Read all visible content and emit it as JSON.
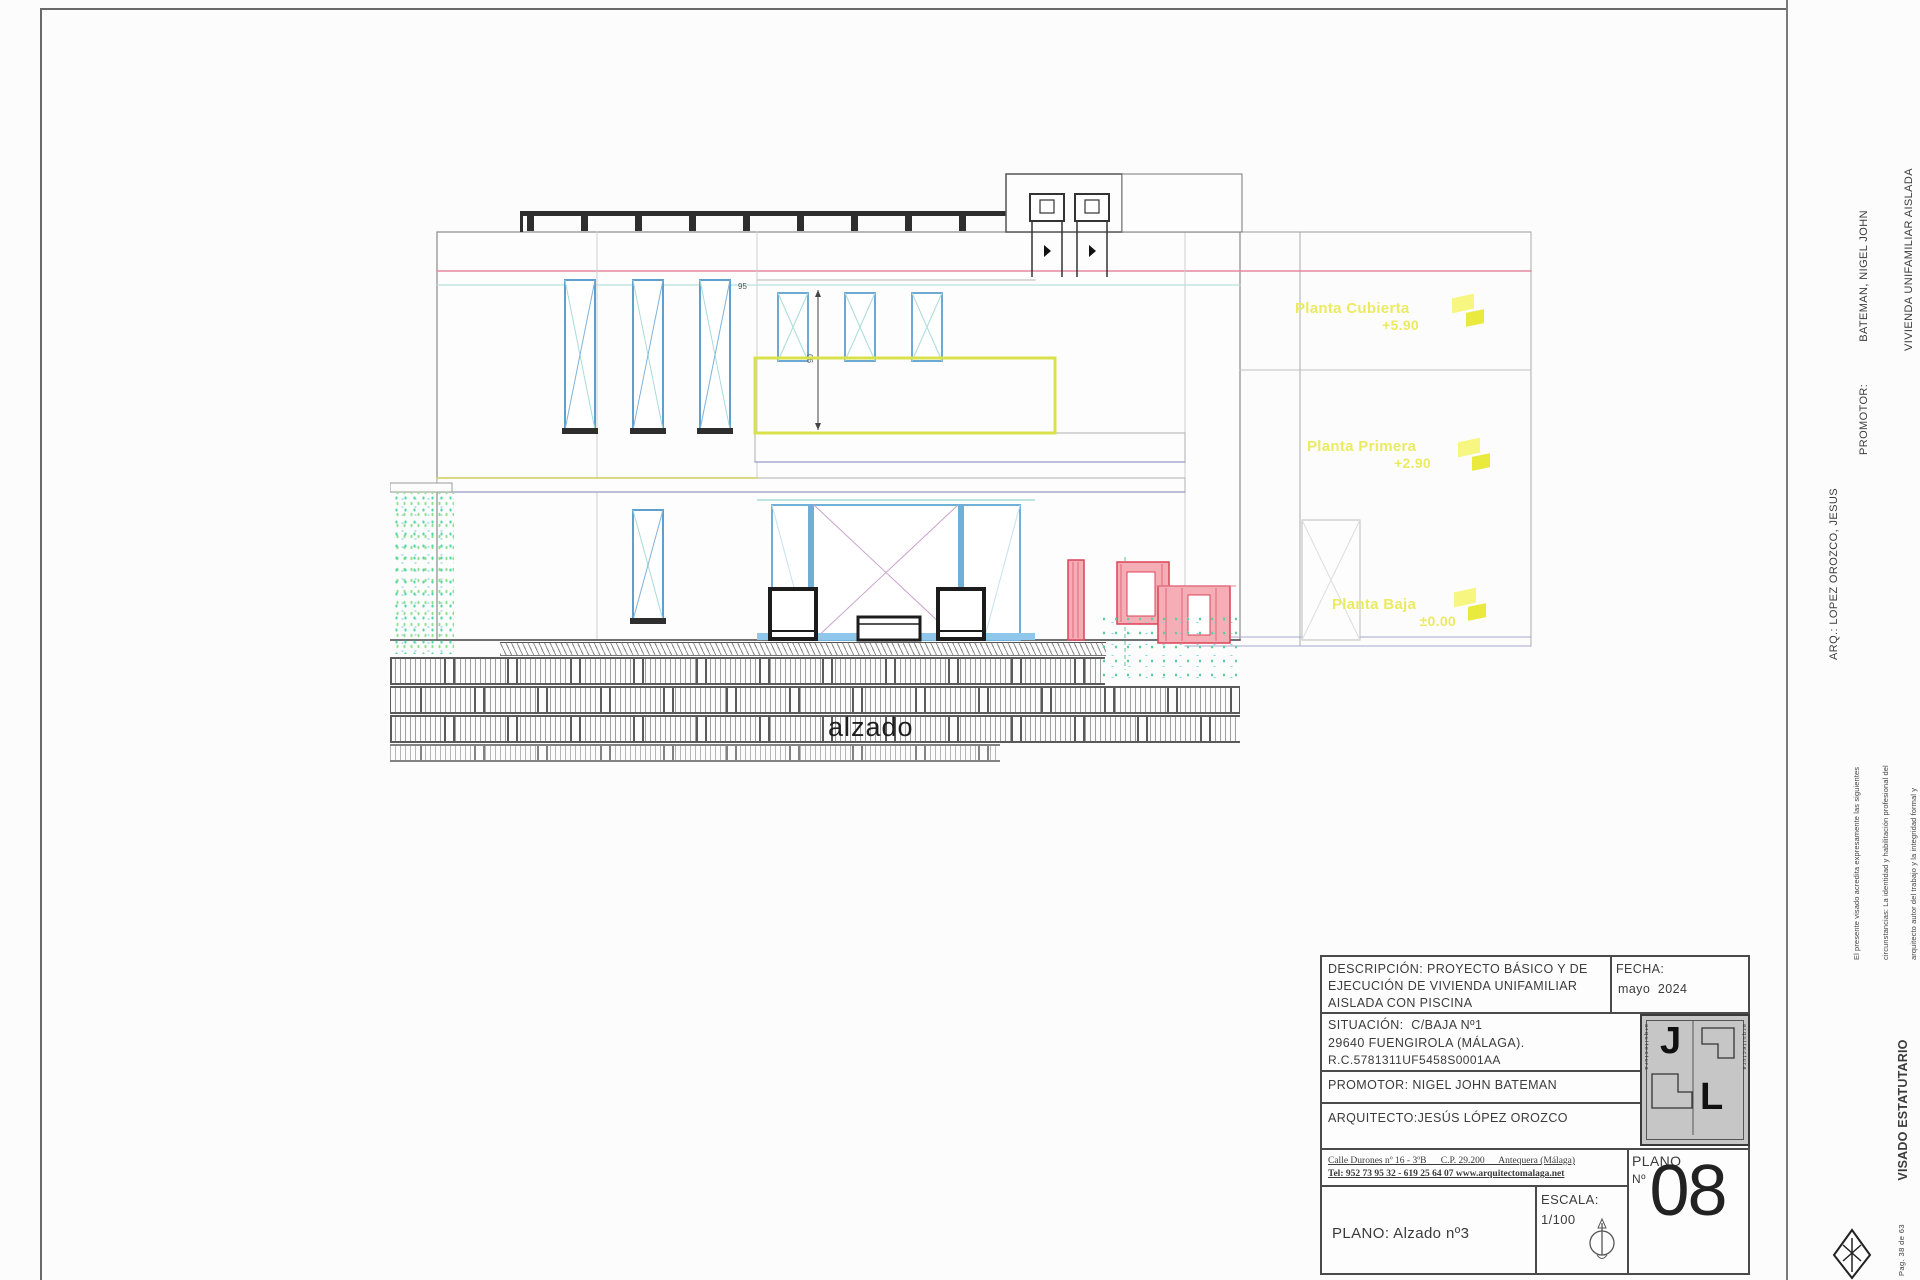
{
  "drawing": {
    "caption": "alzado",
    "levels": [
      {
        "name": "Planta Cubierta",
        "value": "+5.90"
      },
      {
        "name": "Planta Primera",
        "value": "+2.90"
      },
      {
        "name": "Planta Baja",
        "value": "±0.00"
      }
    ],
    "dim_height": "90",
    "dim_width": "95"
  },
  "margin": {
    "promotor_label": "PROMOTOR:",
    "promotor_name": "BATEMAN, NIGEL JOHN",
    "promotor_line2": "VIVIENDA UNIFAMILIAR AISLADA",
    "promotor_line3": "29640 - FUENGIROLA",
    "arquitecto": "ARQ.: LOPEZ OROZCO, JESUS",
    "visado_note_l1": "El presente visado acredita expresamente las siguientes",
    "visado_note_l2": "circunstancias: La identidad y habilitación profesional del",
    "visado_note_l3": "arquitecto autor del trabajo y la integridad formal y",
    "visado_note_l4": "corrección documental según normativa aplicable.",
    "visado_title": "VISADO ESTATUTARIO",
    "visado_expediente": "26/06/2024 - Nº Expte. 2024/002448/001",
    "colegio_l1": "COLEGIO OFICIAL DE",
    "colegio_l2": "ARQUITECTOS DE MÁLAGA",
    "page_ref": "Pag. 38 de 63"
  },
  "titleblock": {
    "descripcion_l1": "DESCRIPCIÓN: PROYECTO BÁSICO Y DE",
    "descripcion_l2": "EJECUCIÓN DE VIVIENDA UNIFAMILIAR",
    "descripcion_l3": "AISLADA CON PISCINA",
    "fecha_label": "FECHA:",
    "fecha_value": "mayo  2024",
    "situacion_l1": "SITUACIÓN:  C/BAJA Nº1",
    "situacion_l2": "29640 FUENGIROLA (MÁLAGA).",
    "situacion_l3": "R.C.5781311UF5458S0001AA",
    "promotor": "PROMOTOR: NIGEL JOHN BATEMAN",
    "arquitecto": "ARQUITECTO:JESÚS LÓPEZ OROZCO",
    "address_l1": "Calle Durones nº 16 - 3ºB      C.P. 29.200      Antequera (Málaga)",
    "address_l2": "Tel: 952 73 95 32 - 619 25 64 07 www.arquitectomalaga.net",
    "plano_title": "PLANO: Alzado nº3",
    "escala_label": "ESCALA:",
    "escala_value": "1/100",
    "plano_col_label": "PLANO",
    "plano_col_num": "Nº",
    "plano_number": "08",
    "logo_j": "J",
    "logo_l": "L",
    "logo_side_left": "arquitectura",
    "logo_side_right": "arquitectura"
  },
  "colors": {
    "level_yellow": "#ebeb62",
    "window_blue": "#5e9fd0",
    "balcony_yellow_green": "#d9e24b",
    "section_red": "#dc4356",
    "slab_pink": "#e687a0",
    "pool_green": "#5ecf9a"
  }
}
